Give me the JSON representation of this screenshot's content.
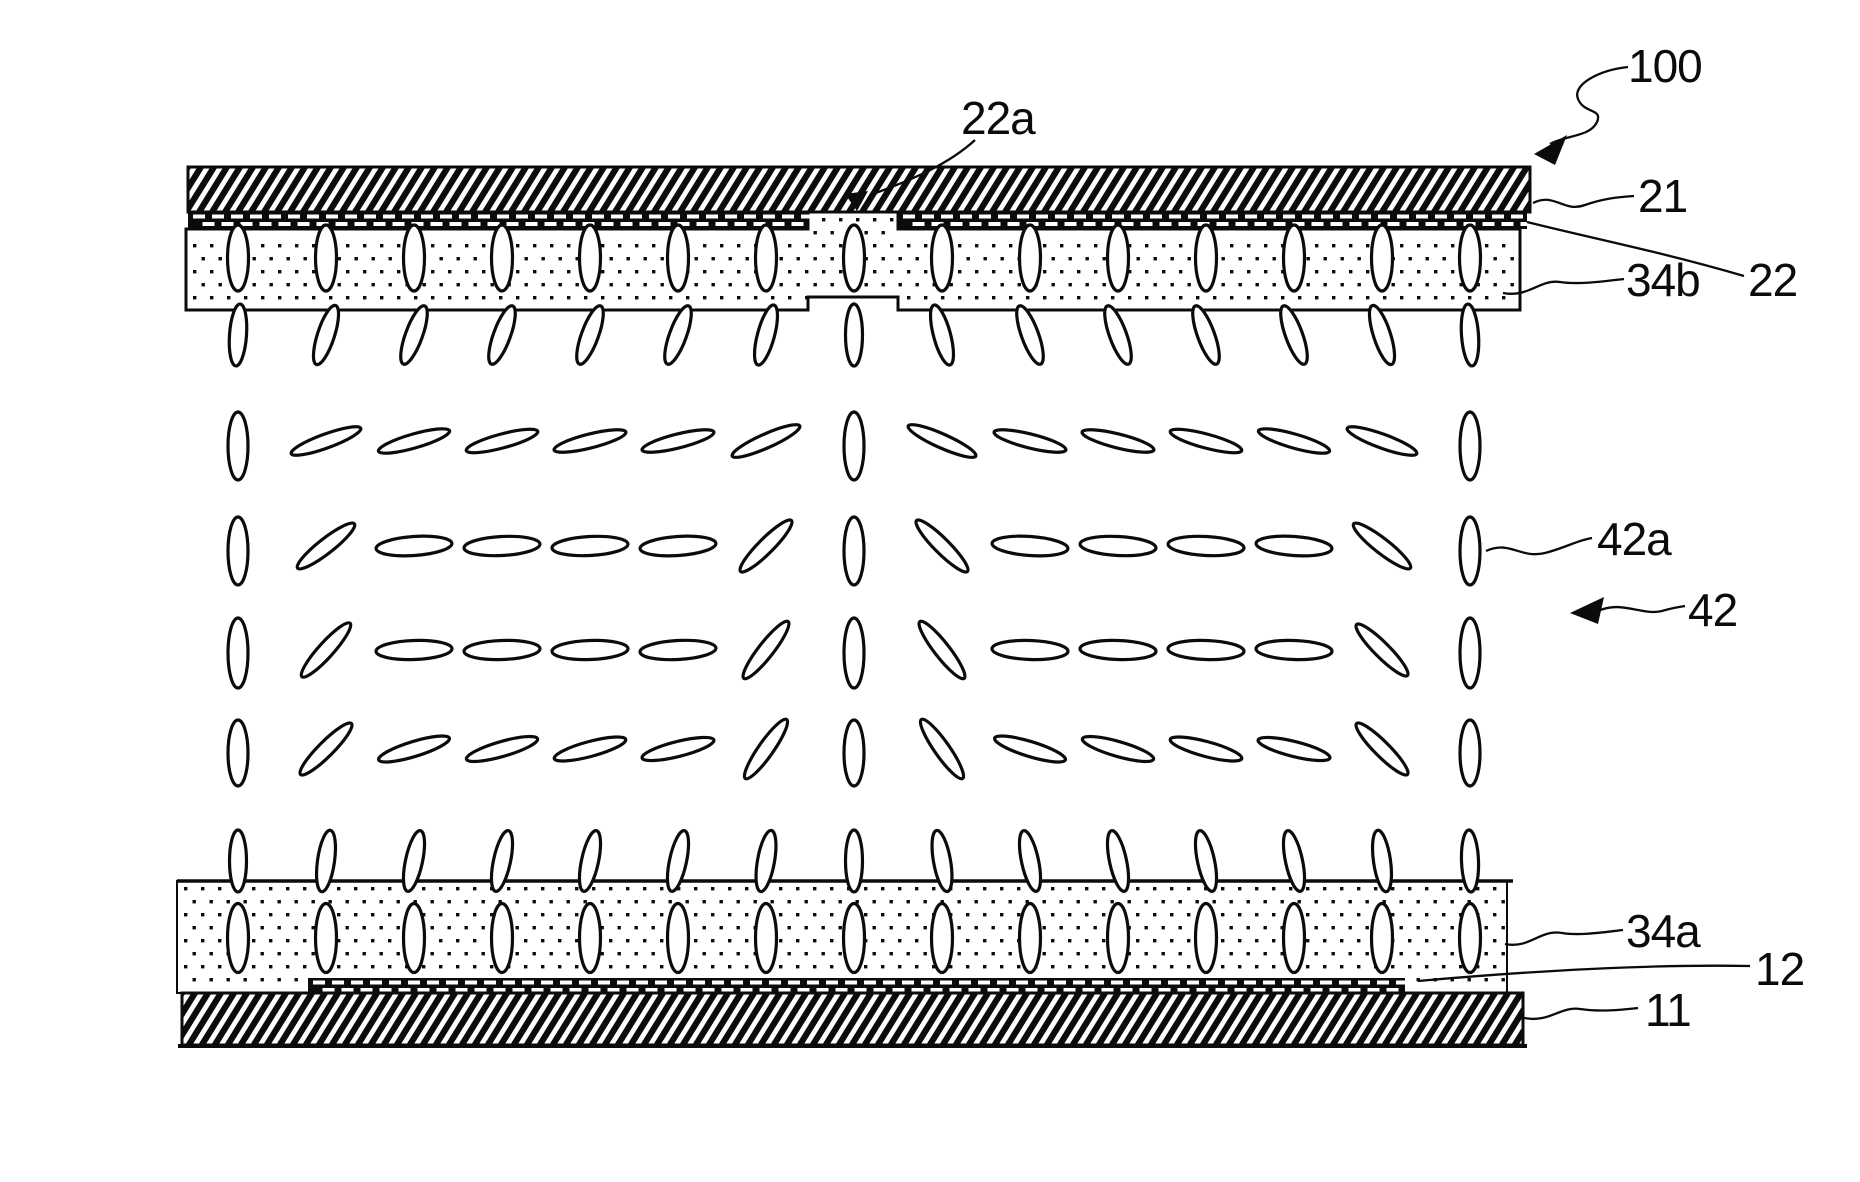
{
  "figure": {
    "title": "LCD cross-section patent figure",
    "canvas": {
      "width": 1860,
      "height": 1182
    },
    "ink": "#0b0b0b",
    "background": "#ffffff"
  },
  "labels": {
    "l100": {
      "text": "100",
      "x": 1628,
      "y": 82
    },
    "l22a": {
      "text": "22a",
      "x": 961,
      "y": 134
    },
    "l21": {
      "text": "21",
      "x": 1638,
      "y": 212
    },
    "l34b": {
      "text": "34b",
      "x": 1626,
      "y": 296
    },
    "l22": {
      "text": "22",
      "x": 1748,
      "y": 296
    },
    "l42a": {
      "text": "42a",
      "x": 1597,
      "y": 555
    },
    "l42": {
      "text": "42",
      "x": 1688,
      "y": 626
    },
    "l34a": {
      "text": "34a",
      "x": 1626,
      "y": 947
    },
    "l12": {
      "text": "12",
      "x": 1755,
      "y": 985
    },
    "l11": {
      "text": "11",
      "x": 1645,
      "y": 1026
    }
  },
  "layers": {
    "substrate21": {
      "x": 188,
      "y": 167,
      "w": 1342,
      "h": 45
    },
    "electrode22": {
      "x": 188,
      "y": 212,
      "w": 1339,
      "h": 17,
      "gap_x1": 808,
      "gap_x2": 898
    },
    "film34b": {
      "x1": 186,
      "x2": 1520,
      "top": 229,
      "bottom": 310,
      "gap_x1": 808,
      "gap_x2": 898,
      "gap_top": 212,
      "gap_bottom": 297
    },
    "film34a": {
      "x1": 177,
      "x2": 1507,
      "top": 881,
      "bottom": 993
    },
    "electrode12": {
      "x": 308,
      "y": 978,
      "w": 1097,
      "h": 15
    },
    "substrate11": {
      "x": 182,
      "y": 993,
      "w": 1341,
      "h": 52
    }
  },
  "hatch": {
    "period": 13,
    "stroke": 6.2,
    "slope": 0.62
  },
  "stipple": {
    "dx": 17,
    "dy": 13,
    "dot": 3.4
  },
  "dashes": {
    "period": 19,
    "len": 12,
    "h": 4
  },
  "lc_field": {
    "col_start": 238,
    "col_step": 88,
    "col_count": 15,
    "steep": {
      "min": 26,
      "max": 64,
      "len": 72,
      "wid": 15
    },
    "rows": [
      {
        "name": "embedded-top",
        "y": 258,
        "len": 66,
        "wid": 21,
        "angles": [
          90,
          90,
          90,
          90,
          90,
          90,
          90,
          90,
          90,
          90,
          90,
          90,
          90,
          90,
          90
        ]
      },
      {
        "name": "hanging",
        "y": 335,
        "len": 62,
        "wid": 17,
        "angles": [
          86,
          72,
          70,
          70,
          70,
          70,
          75,
          90,
          105,
          110,
          110,
          110,
          110,
          108,
          94
        ]
      },
      {
        "name": "bulk-row-a",
        "y": 441,
        "len": 74,
        "wid": 14,
        "vlen": 68,
        "vwid": 20,
        "voff": 5,
        "angles": [
          90,
          20,
          16,
          15,
          14,
          14,
          24,
          90,
          156,
          166,
          166,
          165,
          164,
          160,
          90
        ]
      },
      {
        "name": "bulk-row-b",
        "y": 546,
        "len": 76,
        "wid": 19,
        "vlen": 68,
        "vwid": 20,
        "voff": 5,
        "angles": [
          90,
          38,
          4,
          3,
          3,
          4,
          45,
          90,
          135,
          176,
          177,
          177,
          176,
          142,
          90
        ]
      },
      {
        "name": "bulk-row-c",
        "y": 650,
        "len": 76,
        "wid": 19,
        "vlen": 70,
        "vwid": 20,
        "voff": 3,
        "angles": [
          90,
          48,
          2,
          2,
          2,
          3,
          52,
          90,
          128,
          178,
          178,
          178,
          178,
          135,
          90
        ]
      },
      {
        "name": "bulk-row-d",
        "y": 749,
        "len": 74,
        "wid": 15,
        "vlen": 66,
        "vwid": 20,
        "voff": 4,
        "angles": [
          90,
          45,
          17,
          16,
          15,
          14,
          55,
          90,
          125,
          163,
          164,
          165,
          166,
          135,
          90
        ]
      },
      {
        "name": "standing",
        "y": 861,
        "len": 62,
        "wid": 17,
        "angles": [
          90,
          82,
          78,
          78,
          78,
          78,
          80,
          90,
          100,
          102,
          102,
          102,
          102,
          98,
          92
        ]
      },
      {
        "name": "embedded-bottom",
        "y": 938,
        "len": 69,
        "wid": 21,
        "angles": [
          90,
          90,
          90,
          90,
          90,
          90,
          90,
          90,
          90,
          90,
          90,
          90,
          90,
          90,
          90
        ]
      }
    ]
  },
  "leaders": [
    {
      "name": "leader-100",
      "d": "M1628,67 C1600,70 1572,84 1578,99 C1584,114 1603,108 1597,122 C1590,137 1566,135 1550,144"
    },
    {
      "name": "leader-22a",
      "d": "M975,140 C950,163 915,179 870,195"
    },
    {
      "name": "leader-21",
      "d": "M1533,203 C1555,192 1563,213 1585,205 C1602,199 1617,197 1634,196"
    },
    {
      "name": "leader-22",
      "d": "M1527,222 C1595,239 1662,252 1744,276"
    },
    {
      "name": "leader-34b",
      "d": "M1503,293 C1528,298 1540,279 1560,282 C1580,285 1605,281 1624,279"
    },
    {
      "name": "leader-42a",
      "d": "M1486,551 C1510,540 1520,559 1545,553 C1565,548 1578,540 1592,538"
    },
    {
      "name": "leader-42",
      "d": "M1598,611 C1622,600 1642,616 1662,611 C1672,608 1678,607 1685,606"
    },
    {
      "name": "leader-34a",
      "d": "M1505,944 C1530,949 1540,929 1562,933 C1580,936 1605,932 1623,930"
    },
    {
      "name": "leader-12",
      "d": "M1418,981 C1520,972 1640,964 1750,966"
    },
    {
      "name": "leader-11",
      "d": "M1524,1018 C1550,1023 1560,1006 1580,1009 C1600,1012 1620,1010 1638,1008"
    }
  ],
  "arrowheads": [
    {
      "name": "arrowhead-100",
      "points": "1534,154 1567,135 1555,165"
    },
    {
      "name": "arrowhead-42",
      "points": "1570,613 1604,597 1598,624"
    },
    {
      "name": "arrowhead-22a",
      "points": "857,211 868,191 845,194"
    }
  ]
}
